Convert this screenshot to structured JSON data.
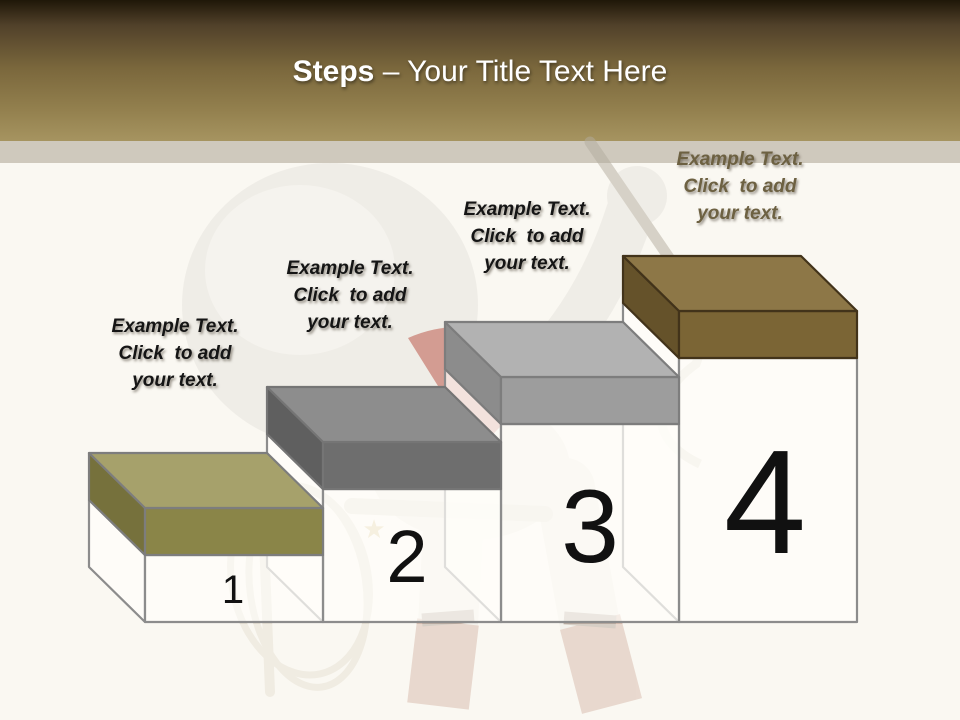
{
  "header": {
    "title_bold": "Steps",
    "title_rest": " – Your Title Text Here",
    "text_color": "#ffffff",
    "gradient_top": "#1f1708",
    "gradient_bottom": "#a69460"
  },
  "canvas": {
    "background": "#faf8f2",
    "strip_color": "#cfc9bd",
    "body_fill": "rgba(255,254,250,0.72)",
    "body_outline": "#8c8c8c",
    "number_color": "#111111"
  },
  "steps": [
    {
      "number": "1",
      "label": "Example Text.\nClick  to add\nyour text.",
      "label_color": "#151515",
      "colors": {
        "top": "#a6a16b",
        "front": "#8a8548",
        "side": "#76713c",
        "outline": "#7d7d7d"
      }
    },
    {
      "number": "2",
      "label": "Example Text.\nClick  to add\nyour text.",
      "label_color": "#151515",
      "colors": {
        "top": "#8d8d8d",
        "front": "#6e6e6e",
        "side": "#5f5f5f",
        "outline": "#757575"
      }
    },
    {
      "number": "3",
      "label": "Example Text.\nClick  to add\nyour text.",
      "label_color": "#151515",
      "colors": {
        "top": "#b2b2b2",
        "front": "#9d9d9d",
        "side": "#8c8c8c",
        "outline": "#7d7d7d"
      }
    },
    {
      "number": "4",
      "label": "Example Text.\nClick  to add\nyour text.",
      "label_color": "#6d6142",
      "colors": {
        "top": "#8d7747",
        "front": "#7b6535",
        "side": "#65522a",
        "outline": "#42331a"
      }
    }
  ],
  "figure": {
    "body_color": "#e6e3dd",
    "highlight_color": "#f2f0ec",
    "scarf_color": "#ae4334",
    "boot_color": "#b98672",
    "boot_cuff_color": "#7a6150",
    "rope_color": "#d6cdbc",
    "stick_color": "#b3ac9e",
    "badge_color": "#c3a44d"
  }
}
